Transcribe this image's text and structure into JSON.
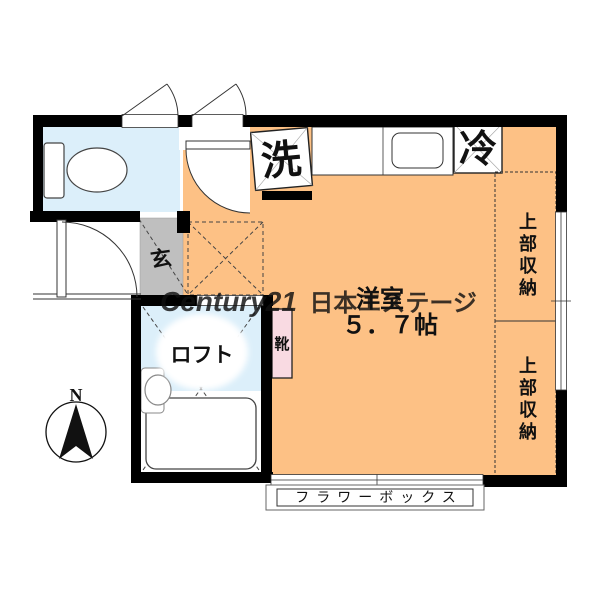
{
  "colors": {
    "wall": "#000000",
    "room": "#FDC185",
    "wet": "#DCEFFA",
    "genkan": "#BFBFBF",
    "shoebox": "#F9DAE2",
    "watermark": "#C8C8C8"
  },
  "labels": {
    "washer": "洗",
    "fridge": "冷",
    "storage_top": "上部収納",
    "storage_bottom": "上部収納",
    "room_name": "洋室",
    "room_size": "５．７帖",
    "entrance": "玄",
    "shoes": "靴",
    "loft": "ロフト",
    "flower_box": "フラワーボックス",
    "north": "N"
  },
  "watermark": {
    "brand": "Century21",
    "name": "日本エステージ"
  }
}
